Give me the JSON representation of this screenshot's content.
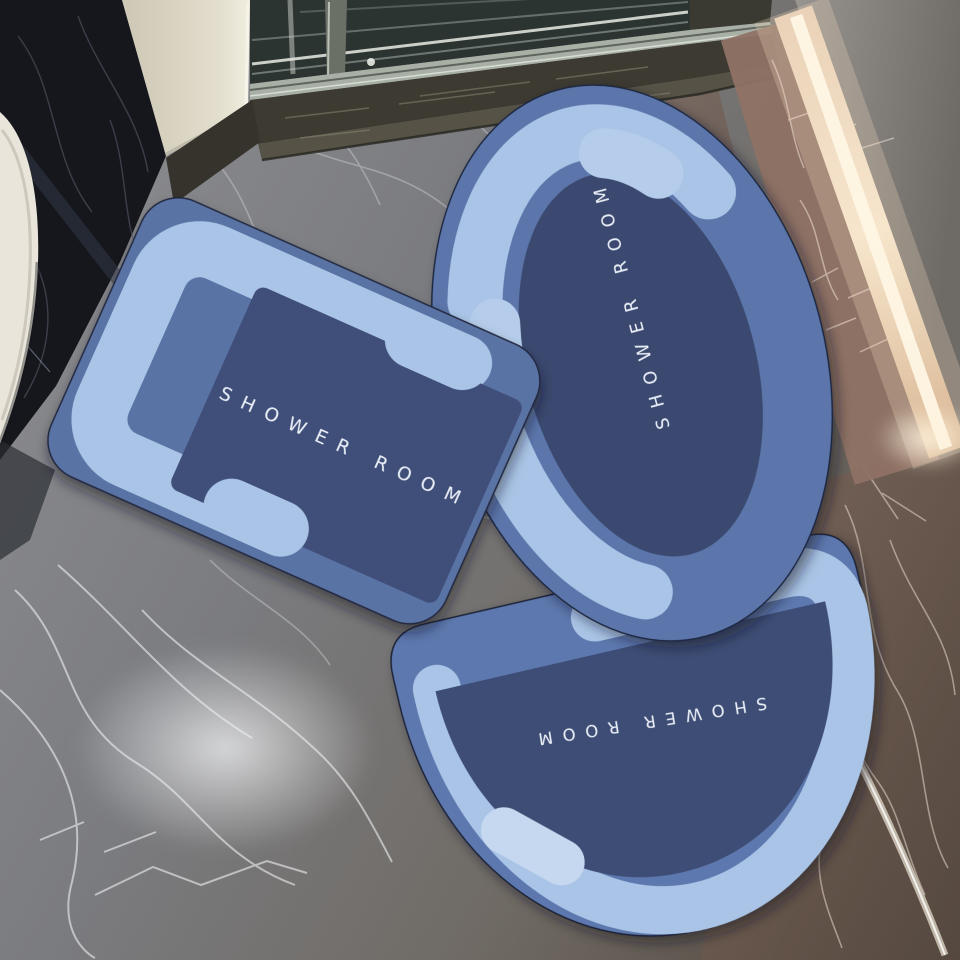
{
  "scene": {
    "type": "photograph",
    "setting": "bathroom with dark marble floor, glass shower door, cream pillar and warm accent light strip",
    "mats": [
      {
        "shape": "rectangular",
        "label": "SHOWER ROOM"
      },
      {
        "shape": "oval",
        "label": "SHOWER ROOM"
      },
      {
        "shape": "half-oval",
        "label": "SHOWER ROOM"
      }
    ],
    "colors": {
      "mat_border_light_blue": "#a9c4e6",
      "mat_capsule_highlight": "#c6d8f0",
      "mat_body_blue": "#5b74a8",
      "mat_center_navy": "#3d4c74",
      "label_text": "#e8eef8",
      "floor_marble_gray": "#7c7d81",
      "floor_marble_brown": "#6b5a50",
      "wall_marble_black": "#15171d",
      "pillar_cream": "#ded9c8",
      "light_strip_warm": "#f6e4c8"
    }
  }
}
